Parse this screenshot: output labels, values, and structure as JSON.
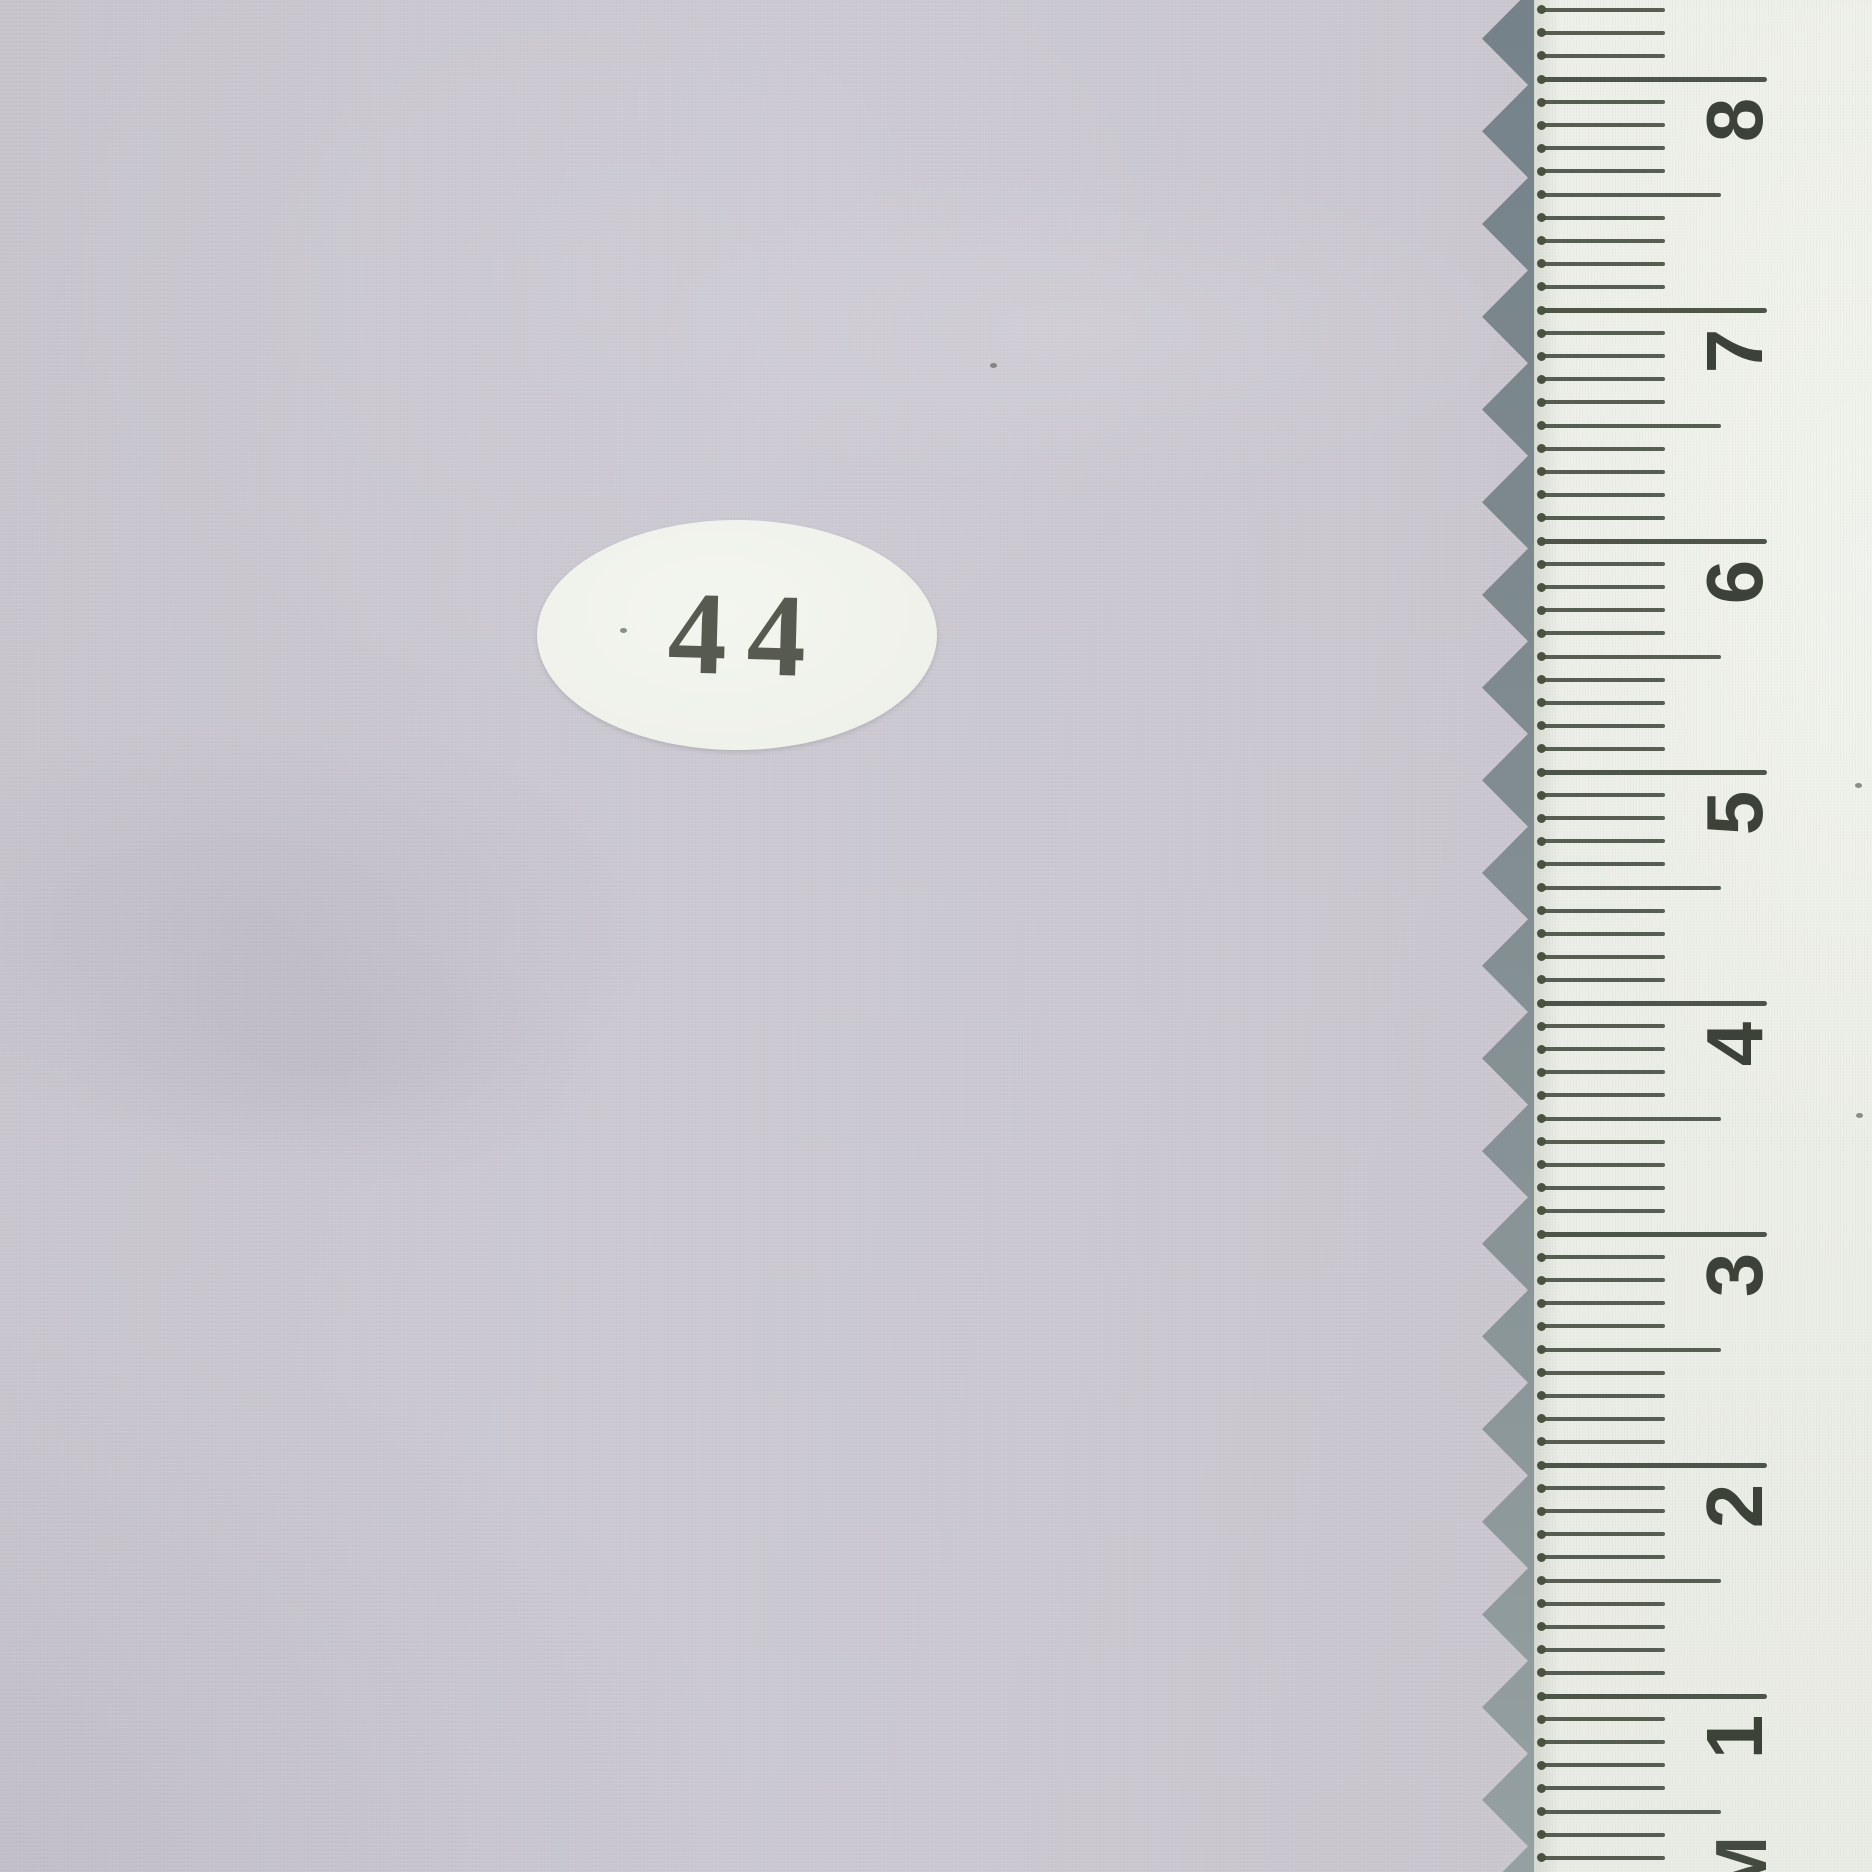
{
  "photo": {
    "kind": "fabric swatch with pinked edge, numbered sticker and centimeter ruler",
    "sticker": {
      "label": "44"
    },
    "ruler": {
      "numbers_top_to_bottom": [
        "8",
        "7",
        "6",
        "5",
        "4",
        "3",
        "2",
        "1"
      ],
      "unit_suffix": "M",
      "divisions_per_unit": 10
    },
    "colors": {
      "fabric": "#c9c6ce",
      "edge_shadow": "#7e8a8e",
      "ruler_face": "#edf0e8",
      "tick": "#565e51",
      "numeral": "#3c4238",
      "sticker_face": "#f0f2ec",
      "sticker_text": "#4a4f42"
    },
    "specks": [
      {
        "x": 990,
        "y": 363
      },
      {
        "x": 620,
        "y": 628
      },
      {
        "x": 1855,
        "y": 783
      },
      {
        "x": 1856,
        "y": 1113
      }
    ]
  }
}
